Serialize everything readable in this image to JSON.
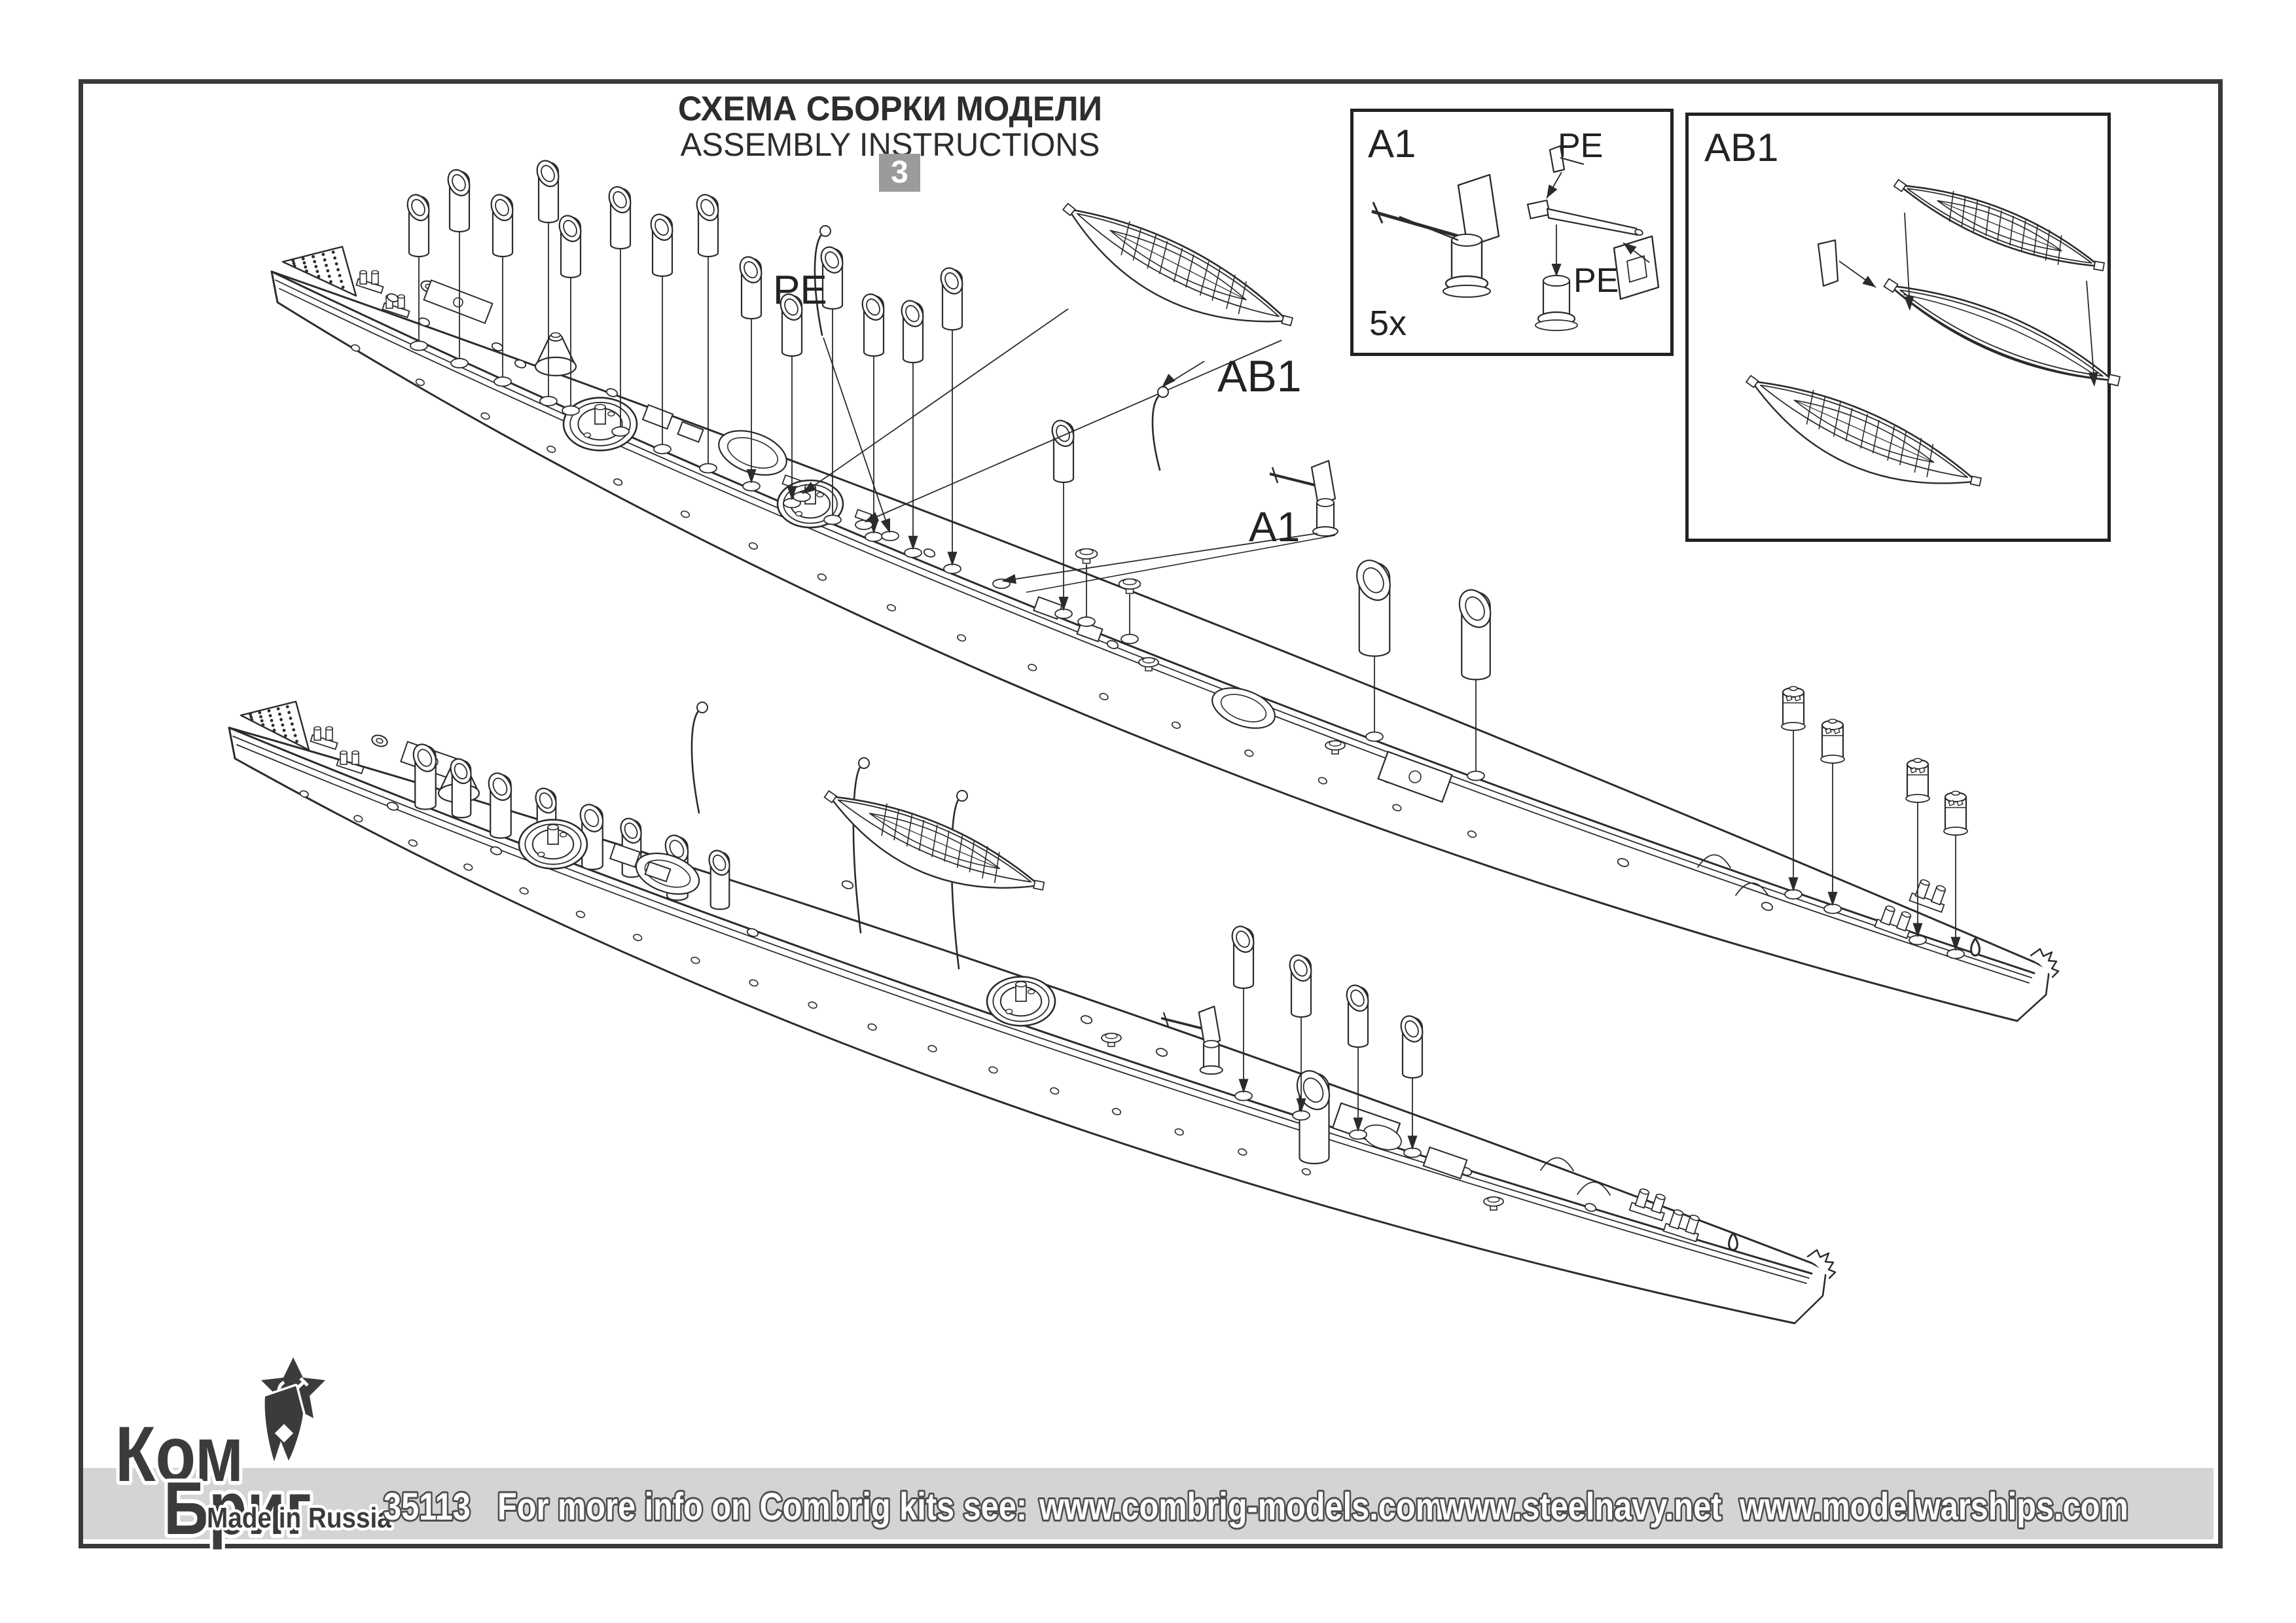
{
  "title": {
    "line1_ru": "СХЕМА СБОРКИ МОДЕЛИ",
    "line2_en": "ASSEMBLY INSTRUCTIONS",
    "step_number": "3"
  },
  "callouts": {
    "pe": "PE",
    "ab1": "AB1",
    "a1": "A1"
  },
  "insets": {
    "a1": {
      "label": "A1",
      "quantity": "5x",
      "pe_top": "PE",
      "pe_side": "PE"
    },
    "ab1": {
      "label": "AB1"
    }
  },
  "footer": {
    "kit_number": "35113",
    "info_text": "For more info on Combrig kits see:",
    "site1": "www.combrig-models.com",
    "site2": "www.steelnavy.net",
    "site3": "www.modelwarships.com"
  },
  "logo": {
    "word1": "Ком",
    "word2": "Бриг",
    "tagline": "Made in Russia",
    "star_icon": "soviet-star-hammer-sickle",
    "flag_icon": "naval-pennant"
  },
  "colors": {
    "ink": "#2b2b2b",
    "band": "#d3d4d6",
    "badge_bg": "#9b9b9b",
    "border": "#3a3a3a",
    "logo_ink": "#3b3b3b"
  }
}
